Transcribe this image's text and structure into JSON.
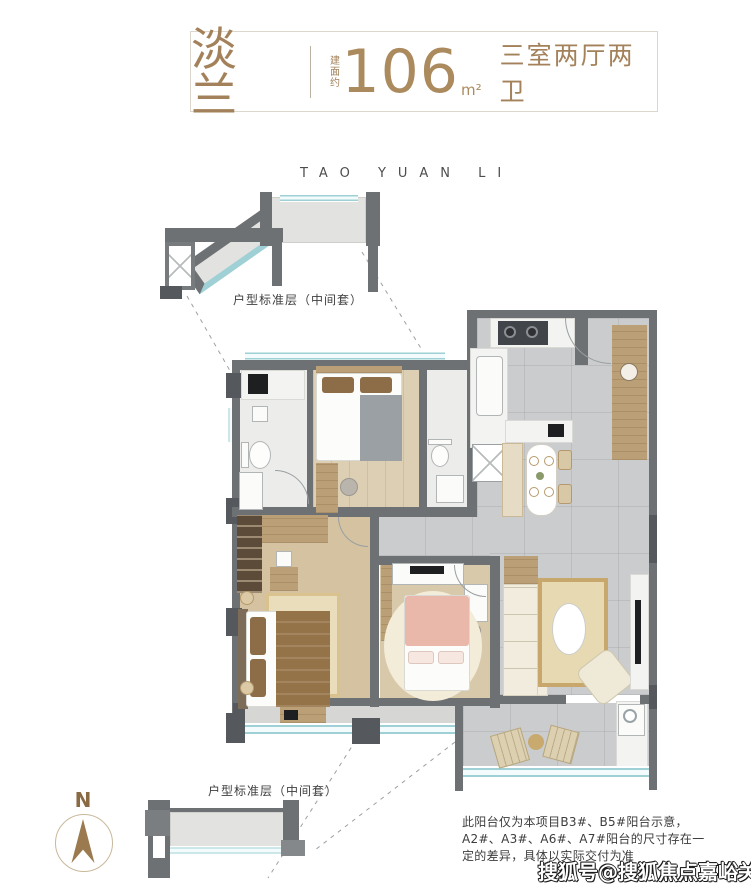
{
  "header": {
    "name": "淡兰",
    "area_label": "建面约",
    "area_value": "106",
    "area_unit": "m²",
    "layout": "三室两厅两卫"
  },
  "project_name": "TAO YUAN LI",
  "floor_key_plans": {
    "top_label": "户型标准层（中间套）",
    "bottom_label": "户型标准层（中间套）"
  },
  "compass": {
    "label": "N"
  },
  "disclaimer": {
    "lines": [
      "此阳台仅为本项目B3#、B5#阳台示意，",
      "A2#、A3#、A6#、A7#阳台的尺寸存在一",
      "定的差异，具体以实际交付为准"
    ]
  },
  "watermark": "搜狐号@搜狐焦点嘉峪关站",
  "colors": {
    "accent": "#a3815a",
    "wall": "#6e7174",
    "walld": "#55585c",
    "window": "#9ed0d6",
    "tile": "#cbccce",
    "wood": "#d5c2a1",
    "marble": "#f3f3f1",
    "rug": "#e9ddbc",
    "sofa": "#f1ecdd",
    "pink": "#eab7ab",
    "textile": "#957349",
    "closet": "#5d4b3a"
  }
}
